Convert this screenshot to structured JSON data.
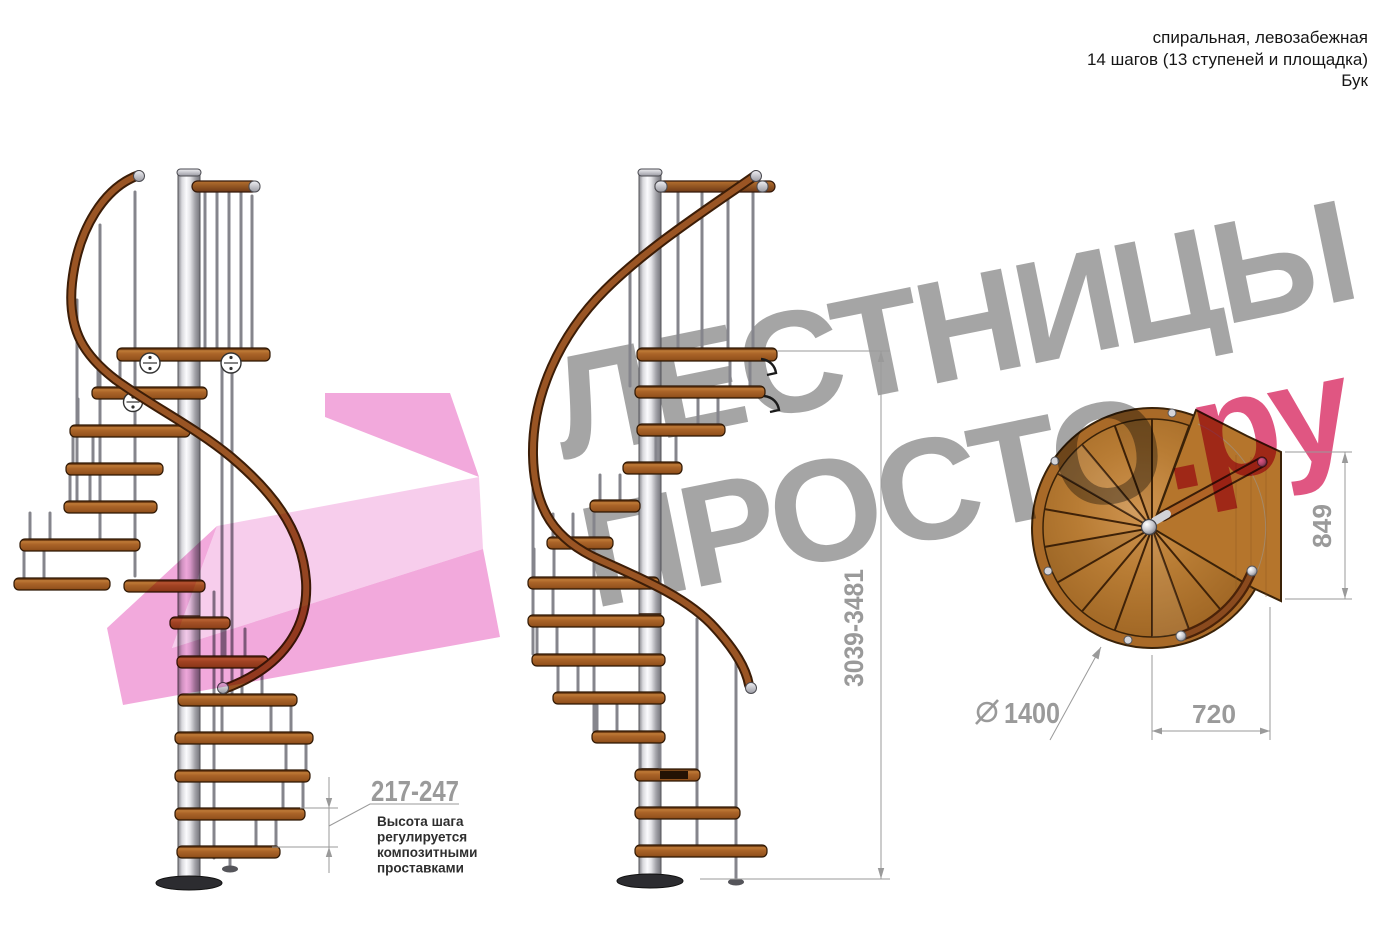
{
  "header": {
    "lines": [
      "спиральная, левозабежная",
      "14 шагов (13 ступеней и площадка)",
      "Бук"
    ]
  },
  "watermark": {
    "line1": "ЛЕСТНИЦЫ",
    "line2": "ПРОСТО",
    "suffix": ".ру",
    "gray_color": "#a8a8a8",
    "pink_color": "#e0487a"
  },
  "dimensions": {
    "step_height": "217-247",
    "total_height": "3039-3481",
    "landing_side": "849",
    "landing_width": "720",
    "diameter": "1400",
    "diameter_symbol": "⌀"
  },
  "note": {
    "lines": [
      "Высота шага",
      "регулируется",
      "композитными",
      "проставками"
    ]
  },
  "colors": {
    "wood_step": "#a9612a",
    "wood_disc": "#b87c34",
    "handrail": "#9a5524",
    "metal_pole": "#d9d9dd",
    "dimension_gray": "#9a9a9a",
    "pink_watermark": "#ea74c6"
  }
}
